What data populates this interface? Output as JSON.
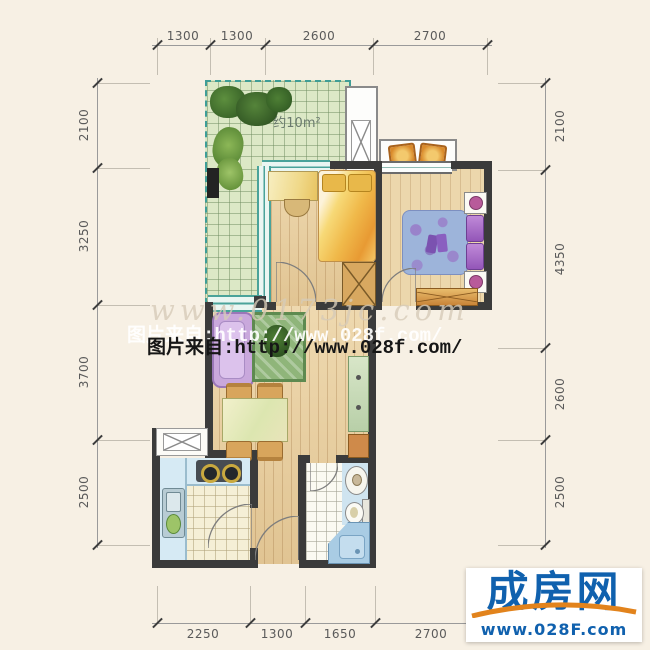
{
  "dims": {
    "top": [
      "1300",
      "1300",
      "2600",
      "2700"
    ],
    "bottom": [
      "2250",
      "1300",
      "1650",
      "2700"
    ],
    "left": [
      "2100",
      "3250",
      "3700",
      "2500"
    ],
    "right": [
      "2100",
      "4350",
      "2600",
      "2500"
    ]
  },
  "plan": {
    "terrace_area_label": "约10m²"
  },
  "watermarks": {
    "faint": "www.0173jc.com",
    "shadow_line": "图片来自:http://www.028f.com/",
    "main_line": "图片来自:http://www.028f.com/"
  },
  "logo": {
    "title": "成房网",
    "url": "www.028F.com"
  },
  "colors": {
    "background": "#f7f0e4",
    "wall": "#3b3b3b",
    "terrace_green": "#dce8c6",
    "wood_floor": "#e7cd9e",
    "window_teal": "#4aa39a",
    "kitchen_blue": "#d6eaf4",
    "sofa_lavender": "#c9a8dc",
    "bed_warm_yellow": "#f0b94a",
    "bed_cool_blue": "#9db4da",
    "logo_blue": "#1061ae",
    "logo_orange": "#e2831c"
  }
}
